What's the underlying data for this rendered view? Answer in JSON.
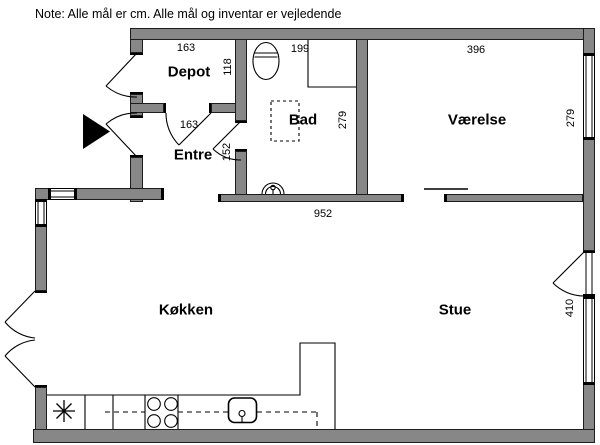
{
  "note": "Note: Alle mål er cm. Alle mål og inventar er vejledende",
  "rooms": {
    "depot": {
      "label": "Depot",
      "width": "163",
      "depth": "118"
    },
    "entre": {
      "label": "Entre",
      "width": "163",
      "depth": "152"
    },
    "bad": {
      "label": "Bad",
      "width": "199",
      "depth": "279"
    },
    "vaerelse": {
      "label": "Værelse",
      "width": "396",
      "depth": "279"
    },
    "koekken": {
      "label": "Køkken"
    },
    "stue": {
      "label": "Stue",
      "depth": "410"
    },
    "living_area": {
      "width": "952"
    }
  },
  "fixtures": {
    "toilet": "toilet",
    "bathroom_sink": "håndvask",
    "shower": "bruseniche",
    "kitchen_sink": "køkkenvask",
    "stove": "kogeplader",
    "freezer_star": "frys",
    "entrance_marker": "indgang"
  },
  "colors": {
    "wall_fill": "#878787",
    "wall_outline": "#1c1c1c",
    "background": "#ffffff",
    "text": "#000000"
  }
}
